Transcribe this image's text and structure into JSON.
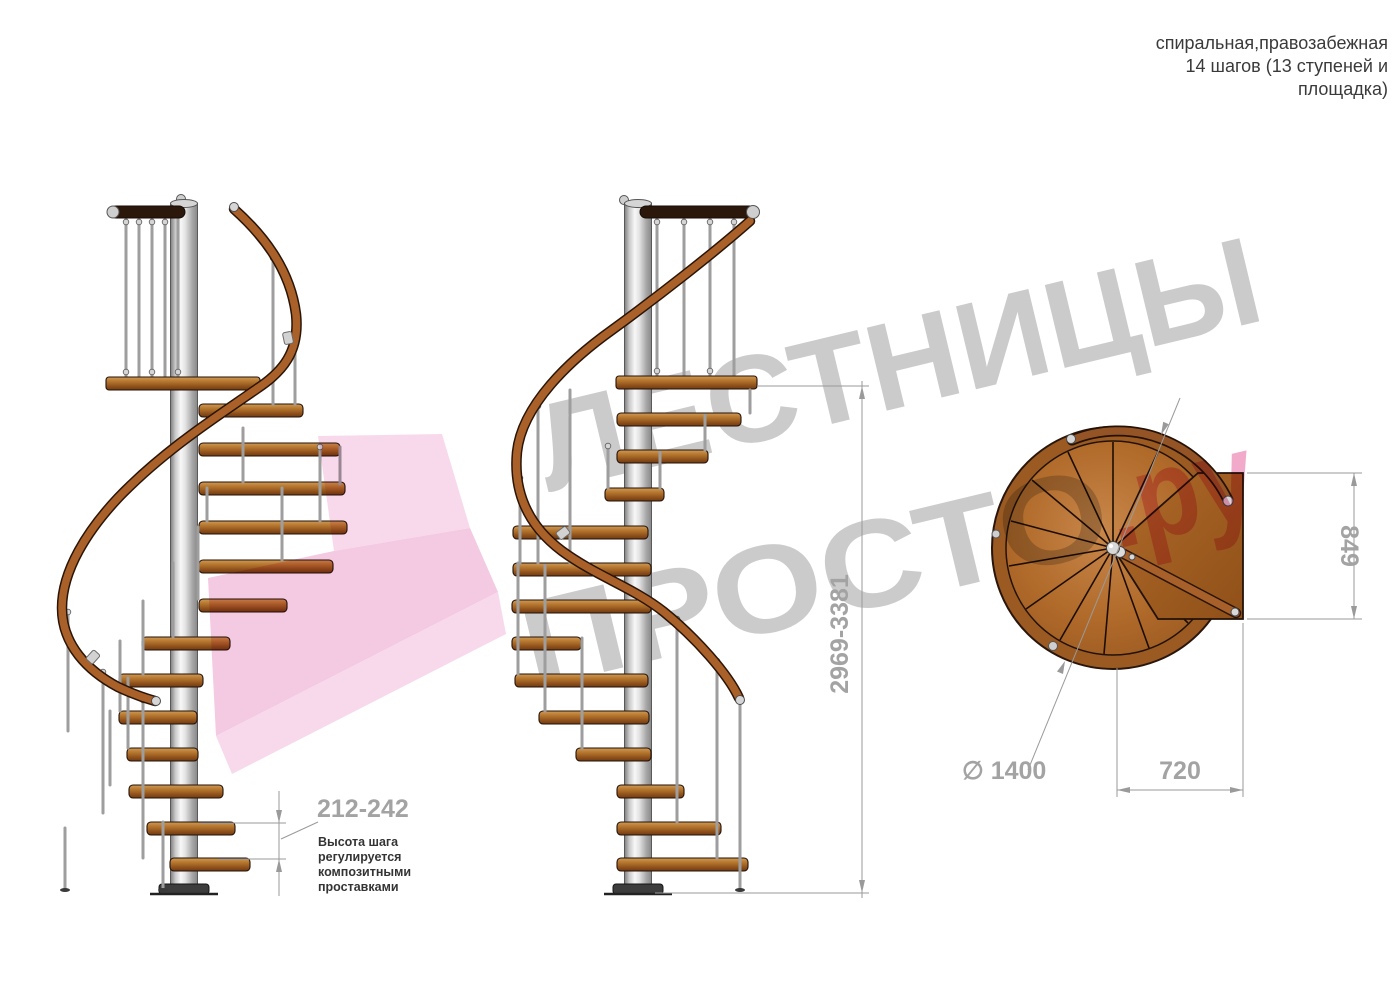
{
  "title": {
    "lines": [
      "спиральная,правозабежная",
      "14 шагов (13 ступеней и",
      "площадка)"
    ]
  },
  "watermark": {
    "word1": "ЛЕСТНИЦЫ",
    "word2": "ПРОСТО",
    "word2_suffix": ".ру"
  },
  "dimensions": {
    "total_height": "2969-3381",
    "step_height": "212-242",
    "platform_depth": "849",
    "platform_width": "720",
    "diameter": "∅ 1400"
  },
  "note": {
    "lines": [
      "Высота шага",
      "регулируется",
      "композитными",
      "проставками"
    ]
  },
  "colors": {
    "wood": "#aa6129",
    "wood_dark": "#2a1508",
    "steel": "#d8d8d8",
    "dim_text": "#a3a3a3",
    "watermark_gray": "#cbcbcb",
    "watermark_pink": "#f2aacb",
    "note_text": "#343434",
    "title_text": "#3a3a3a"
  }
}
